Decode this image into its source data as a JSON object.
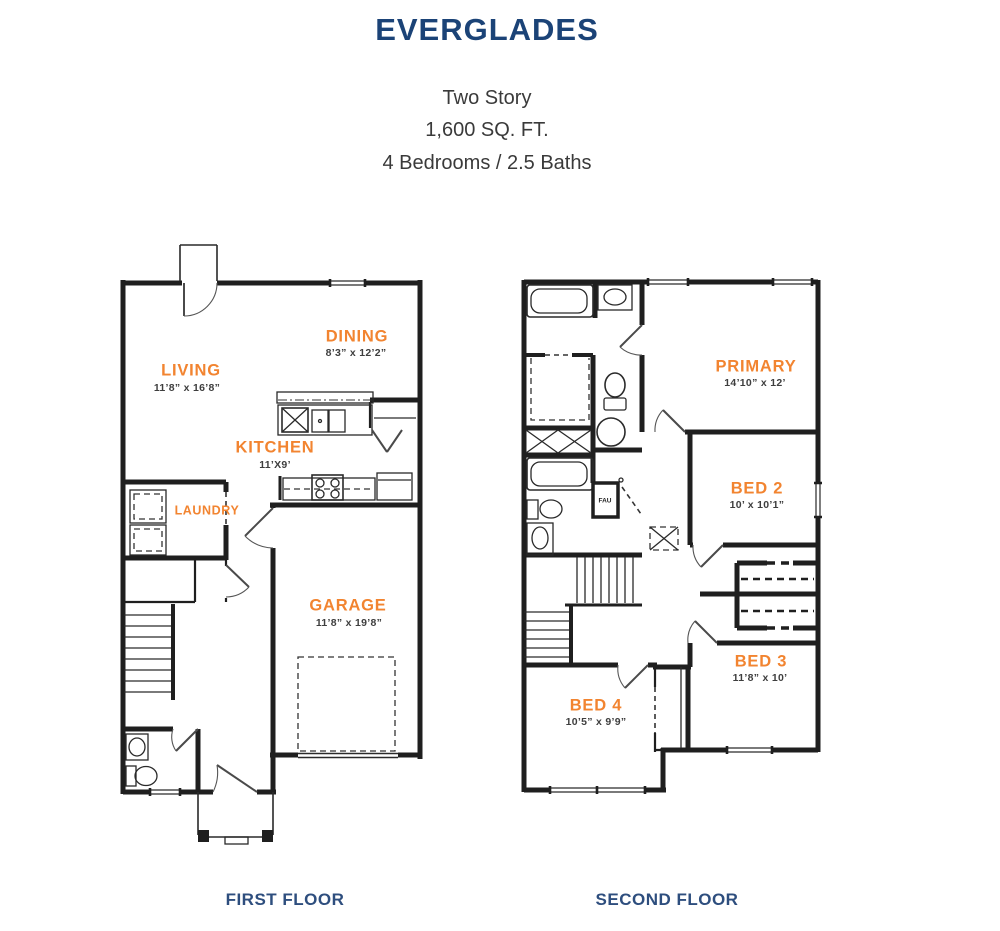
{
  "header": {
    "title": "EVERGLADES",
    "subtitle_lines": [
      "Two Story",
      "1,600 SQ. FT.",
      "4 Bedrooms / 2.5 Baths"
    ]
  },
  "colors": {
    "title_navy": "#1B4377",
    "caption_navy": "#2E4E7E",
    "room_label_orange": "#F28430",
    "dims_gray": "#3E3E3E",
    "wall_black": "#1F1F1F"
  },
  "first_floor": {
    "caption": "FIRST FLOOR",
    "rooms": [
      {
        "name": "LIVING",
        "dims": "11’8” x 16’8”"
      },
      {
        "name": "DINING",
        "dims": "8’3” x 12’2”"
      },
      {
        "name": "KITCHEN",
        "dims": "11’X9’"
      },
      {
        "name": "LAUNDRY",
        "dims": ""
      },
      {
        "name": "GARAGE",
        "dims": "11’8” x 19’8”"
      }
    ]
  },
  "second_floor": {
    "caption": "SECOND FLOOR",
    "rooms": [
      {
        "name": "PRIMARY",
        "dims": "14’10” x 12’"
      },
      {
        "name": "BED 2",
        "dims": "10’ x 10’1”"
      },
      {
        "name": "BED 3",
        "dims": "11’8” x 10’"
      },
      {
        "name": "BED 4",
        "dims": "10’5” x 9’9”"
      }
    ],
    "labels": {
      "fau": "FAU"
    }
  }
}
